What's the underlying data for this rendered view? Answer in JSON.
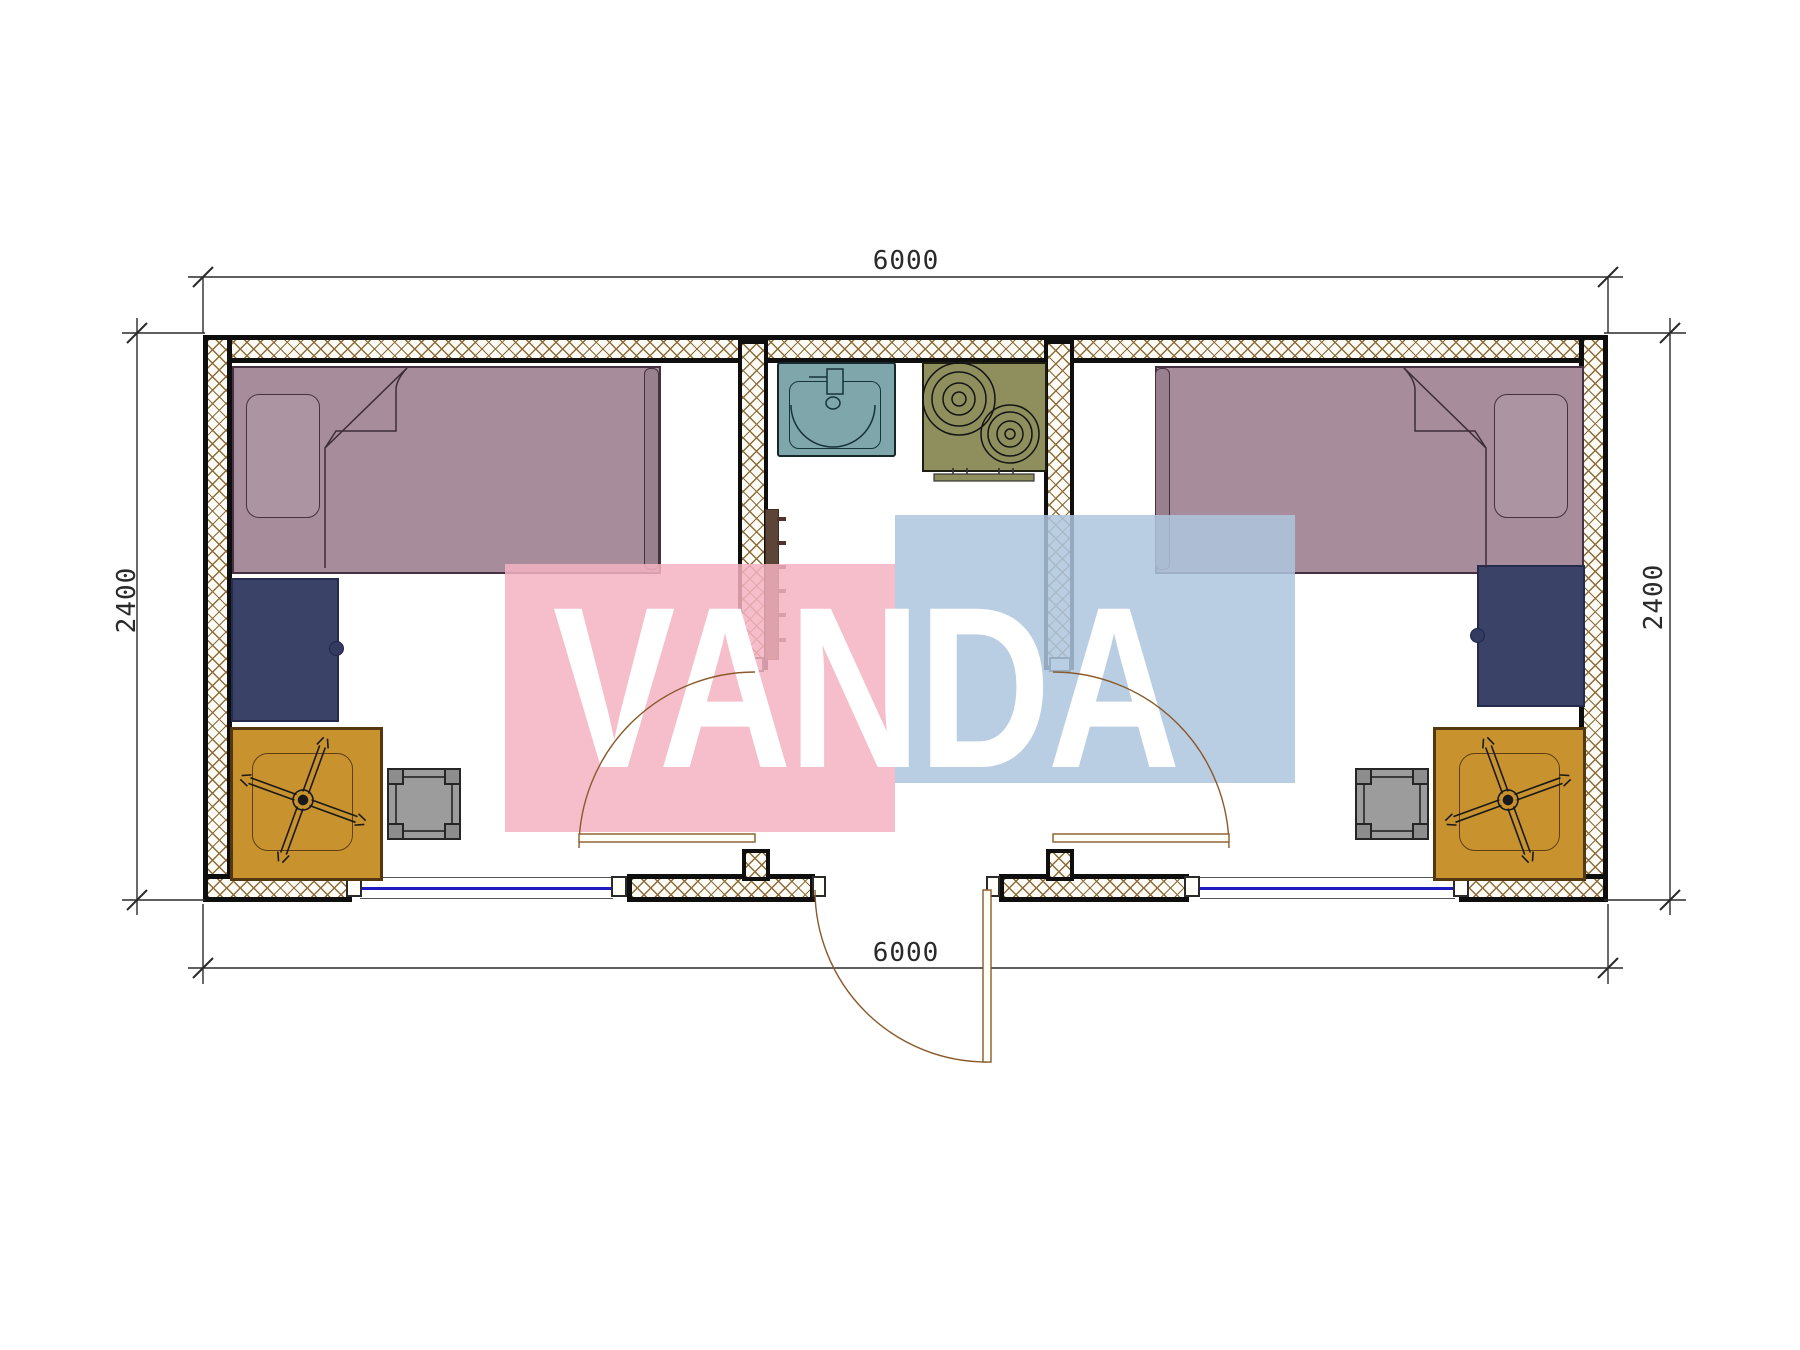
{
  "document": {
    "type": "architectural floor plan - twin-room container unit, top view",
    "grid": "off"
  },
  "watermark": {
    "text": "VANDA"
  },
  "dimensions": {
    "top": "6000",
    "bottom": "6000",
    "left": "2400",
    "right": "2400"
  },
  "symbols": {
    "bed": "bed-symbol",
    "pillow": "pillow-symbol",
    "blanket_fold": "blanket-fold-symbol",
    "desk": "desk-symbol",
    "table_with_chair": "table-chair-symbol",
    "stool": "stool-symbol",
    "sink": "sink-symbol",
    "stove": "stove-two-burner-symbol",
    "heater": "towel-radiator-symbol",
    "door_swing": "door-swing-arc-symbol",
    "window": "window-symbol",
    "wall_hatch": "insulated-wall-crosshatch"
  },
  "colors": {
    "hatch": "#8b6b37",
    "mauve": "#a78d9c",
    "mauvedark": "#99808f",
    "mauvelight": "#ad94a2",
    "navy": "#3b4268",
    "orange": "#c8932f",
    "gray": "#9c9c9c",
    "teal": "#7fa6ab",
    "olive": "#8f8f5e",
    "brown": "#5c4536",
    "winblue": "#1d1dc2",
    "door": "#8a5a2a",
    "wmpink": "#f4b3c2",
    "wmblue": "#aec5de",
    "line": "#2a2a2a"
  }
}
